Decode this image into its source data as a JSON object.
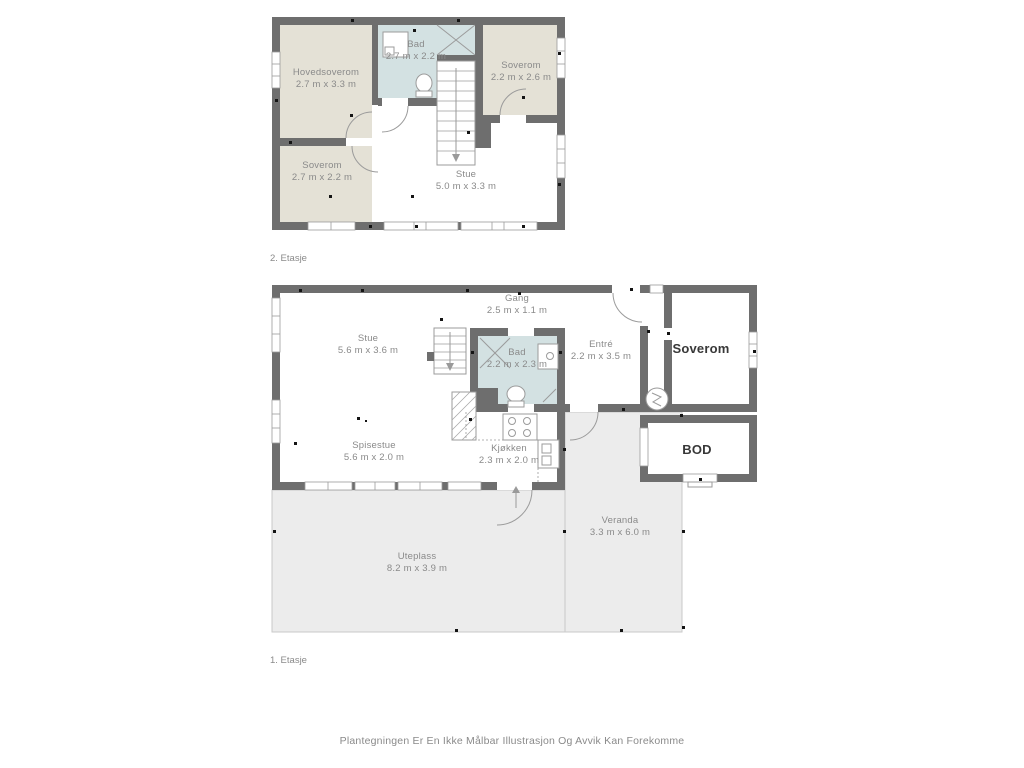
{
  "page": {
    "footer_disclaimer": "Plantegningen Er En Ikke Målbar Illustrasjon Og Avvik Kan Forekomme"
  },
  "colors": {
    "wall": "#6e6e6e",
    "room_beige": "#e4e1d6",
    "room_bath_blue": "#d3e1e2",
    "room_white": "#ffffff",
    "outdoor_gray": "#ececec",
    "outdoor_border": "#c9c9c9",
    "fixture_gray": "#9b9b9b",
    "label_gray": "#8a8a8a",
    "label_dark": "#383838"
  },
  "floors": [
    {
      "id": "second-floor",
      "label": "2. Etasje",
      "rooms": [
        {
          "name": "Hovedsoverom",
          "dims": "2.7 m x 3.3 m"
        },
        {
          "name": "Bad",
          "dims": "2.7 m x 2.2 m"
        },
        {
          "name": "Soverom",
          "dims": "2.2 m x 2.6 m"
        },
        {
          "name": "Soverom",
          "dims": "2.7 m x 2.2 m"
        },
        {
          "name": "Stue",
          "dims": "5.0 m x 3.3 m"
        }
      ]
    },
    {
      "id": "first-floor",
      "label": "1. Etasje",
      "rooms": [
        {
          "name": "Gang",
          "dims": "2.5 m x 1.1 m"
        },
        {
          "name": "Stue",
          "dims": "5.6 m x 3.6 m"
        },
        {
          "name": "Bad",
          "dims": "2.2 m x 2.3 m"
        },
        {
          "name": "Entré",
          "dims": "2.2 m x 3.5 m"
        },
        {
          "name": "Soverom",
          "dims": ""
        },
        {
          "name": "Spisestue",
          "dims": "5.6 m x 2.0 m"
        },
        {
          "name": "Kjøkken",
          "dims": "2.3 m x 2.0 m"
        },
        {
          "name": "BOD",
          "dims": ""
        },
        {
          "name": "Veranda",
          "dims": "3.3 m x 6.0 m"
        },
        {
          "name": "Uteplass",
          "dims": "8.2 m x 3.9 m"
        }
      ]
    }
  ]
}
